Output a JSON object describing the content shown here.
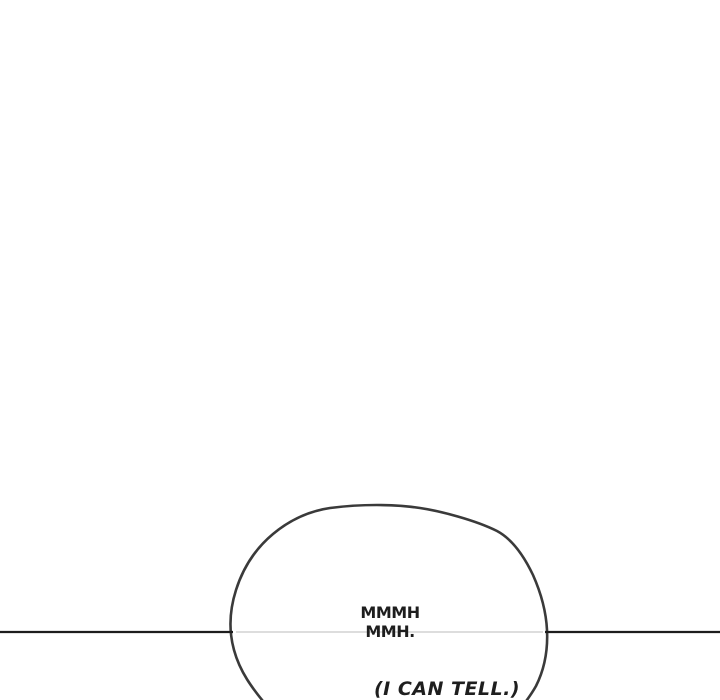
{
  "panel": {
    "type": "webtoon-comic-panel"
  },
  "bubble": {
    "line1": "MMMH",
    "line2": "MMH."
  },
  "caption": {
    "text": "(I CAN TELL.)"
  },
  "colors": {
    "background": "#ffffff",
    "ink": "#1e1e1e",
    "outline": "#3a3a3a",
    "divider": "#1d1d1d",
    "divider_inside": "#d8d8d8"
  }
}
